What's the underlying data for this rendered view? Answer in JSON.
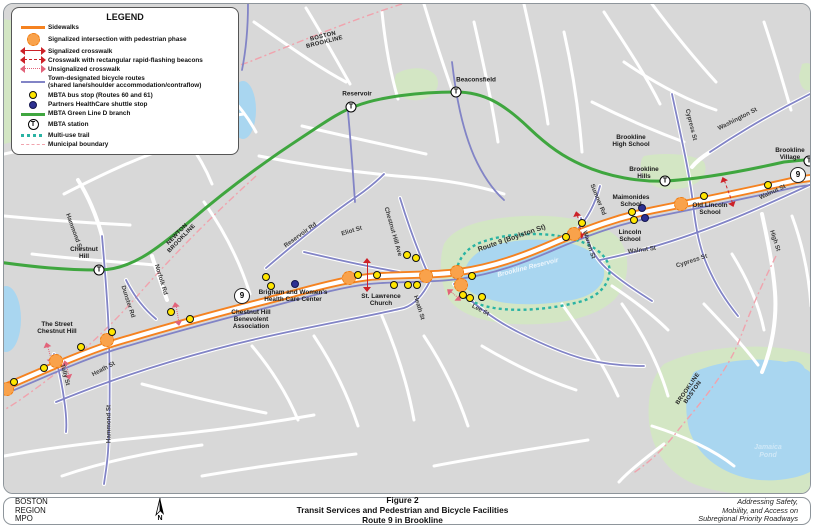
{
  "legend": {
    "title": "LEGEND",
    "items": [
      {
        "symbol": "sidewalk-line",
        "label": "Sidewalks"
      },
      {
        "symbol": "signalized-intersection",
        "label": "Signalized intersection with pedestrian phase"
      },
      {
        "symbol": "signalized-crosswalk",
        "label": "Signalized crosswalk"
      },
      {
        "symbol": "rrfb-crosswalk",
        "label": "Crosswalk with rectangular rapid-flashing beacons"
      },
      {
        "symbol": "unsignalized-crosswalk",
        "label": "Unsignalized crosswalk"
      },
      {
        "symbol": "bicycle-route",
        "label": "Town-designated bicycle routes\n(shared lane/shoulder accommodation/contraflow)"
      },
      {
        "symbol": "bus-stop",
        "label": "MBTA bus stop (Routes 60 and 61)"
      },
      {
        "symbol": "shuttle-stop",
        "label": "Partners HealthCare shuttle stop"
      },
      {
        "symbol": "green-line",
        "label": "MBTA Green Line D branch"
      },
      {
        "symbol": "mbta-station",
        "label": "MBTA station"
      },
      {
        "symbol": "multi-use-trail",
        "label": "Multi-use trail"
      },
      {
        "symbol": "municipal-boundary",
        "label": "Municipal boundary"
      }
    ]
  },
  "footer": {
    "agency_lines": [
      "BOSTON",
      "REGION",
      "MPO"
    ],
    "north_label": "N",
    "figure_label": "Figure 2",
    "title": "Transit Services and Pedestrian and Bicycle Facilities",
    "subtitle": "Route 9 in Brookline",
    "tagline": [
      "Addressing Safety,",
      "Mobility, and Access on",
      "Subregional Priority Roadways"
    ]
  },
  "map": {
    "station_glyph": "T",
    "colors": {
      "sidewalk": "#f58220",
      "crosswalk": "#cc2128",
      "unsignalized_crosswalk": "#e2637a",
      "bike_route": "#8284c6",
      "bus_stop": "#ffe600",
      "shuttle_stop": "#2e3192",
      "green_line": "#3fa63f",
      "multi_use_trail": "#2ab3a3",
      "municipal_boundary": "#f0a3ad",
      "water": "#a9d6f0",
      "park": "#d3e6c4",
      "background": "#d8d8d8"
    },
    "labels": [
      {
        "t": "BOSTON\nBROOKLINE",
        "x": 320,
        "y": 36,
        "r": -14,
        "c": "boundary"
      },
      {
        "t": "NEWTON\nBROOKLINE",
        "x": 176,
        "y": 233,
        "r": -46,
        "c": "boundary"
      },
      {
        "t": "BROOKLINE\nBOSTON",
        "x": 687,
        "y": 387,
        "r": -55,
        "c": "boundary"
      },
      {
        "t": "Reservoir",
        "x": 353,
        "y": 90,
        "r": 0,
        "c": "place"
      },
      {
        "t": "Beaconsfield",
        "x": 472,
        "y": 76,
        "r": 0,
        "c": "place"
      },
      {
        "t": "Chestnut\nHill",
        "x": 80,
        "y": 249,
        "r": 0,
        "c": "place"
      },
      {
        "t": "Brookline\nHigh School",
        "x": 627,
        "y": 137,
        "r": 0,
        "c": "place"
      },
      {
        "t": "Brookline\nHills",
        "x": 640,
        "y": 169,
        "r": 0,
        "c": "place"
      },
      {
        "t": "Brookline\nVillage",
        "x": 786,
        "y": 150,
        "r": 0,
        "c": "place"
      },
      {
        "t": "Maimonides\nSchool",
        "x": 627,
        "y": 197,
        "r": 0,
        "c": "place"
      },
      {
        "t": "Lincoln\nSchool",
        "x": 626,
        "y": 232,
        "r": 0,
        "c": "place"
      },
      {
        "t": "Old Lincoln\nSchool",
        "x": 706,
        "y": 205,
        "r": 0,
        "c": "place"
      },
      {
        "t": "The Street\nChestnut Hill",
        "x": 53,
        "y": 324,
        "r": 0,
        "c": "place"
      },
      {
        "t": "Chestnut Hill\nBenevolent\nAssociation",
        "x": 247,
        "y": 316,
        "r": 0,
        "c": "place"
      },
      {
        "t": "Brigham and Women's\nHealth Care Center",
        "x": 289,
        "y": 292,
        "r": 0,
        "c": "place"
      },
      {
        "t": "St. Lawrence\nChurch",
        "x": 377,
        "y": 296,
        "r": 0,
        "c": "place"
      },
      {
        "t": "Hammond St",
        "x": 69,
        "y": 228,
        "r": 70,
        "c": "street"
      },
      {
        "t": "Hammond St",
        "x": 106,
        "y": 420,
        "r": -90,
        "c": "street"
      },
      {
        "t": "Heath St",
        "x": 100,
        "y": 366,
        "r": -28,
        "c": "street"
      },
      {
        "t": "Heath St",
        "x": 414,
        "y": 304,
        "r": 73,
        "c": "street"
      },
      {
        "t": "Tully St",
        "x": 60,
        "y": 371,
        "r": 75,
        "c": "street"
      },
      {
        "t": "Dunster Rd",
        "x": 123,
        "y": 298,
        "r": 72,
        "c": "street"
      },
      {
        "t": "Norfolk Rd",
        "x": 156,
        "y": 276,
        "r": 73,
        "c": "street"
      },
      {
        "t": "Reservoir Rd",
        "x": 297,
        "y": 232,
        "r": -36,
        "c": "street"
      },
      {
        "t": "Eliot St",
        "x": 348,
        "y": 228,
        "r": -17,
        "c": "street"
      },
      {
        "t": "Chestnut Hill Ave",
        "x": 388,
        "y": 228,
        "r": 74,
        "c": "street"
      },
      {
        "t": "Route 9 (Boylston St)",
        "x": 508,
        "y": 235,
        "r": -19,
        "c": "street route9"
      },
      {
        "t": "Lee St",
        "x": 476,
        "y": 307,
        "r": 28,
        "c": "street"
      },
      {
        "t": "Warren St",
        "x": 584,
        "y": 241,
        "r": 72,
        "c": "street"
      },
      {
        "t": "Sumner Rd",
        "x": 593,
        "y": 196,
        "r": 68,
        "c": "street"
      },
      {
        "t": "Walnut St",
        "x": 638,
        "y": 247,
        "r": -7,
        "c": "street"
      },
      {
        "t": "Walnut St",
        "x": 769,
        "y": 189,
        "r": -25,
        "c": "street"
      },
      {
        "t": "Cypress St",
        "x": 686,
        "y": 121,
        "r": 76,
        "c": "street"
      },
      {
        "t": "Cypress St",
        "x": 688,
        "y": 258,
        "r": -18,
        "c": "street"
      },
      {
        "t": "Washington St",
        "x": 734,
        "y": 116,
        "r": -27,
        "c": "street"
      },
      {
        "t": "High St",
        "x": 770,
        "y": 237,
        "r": 72,
        "c": "street"
      },
      {
        "t": "Brookline Reservoir",
        "x": 524,
        "y": 264,
        "r": -14,
        "c": "water-label"
      },
      {
        "t": "Jamaica Pond",
        "x": 764,
        "y": 448,
        "r": 0,
        "c": "water-label jamaica"
      }
    ],
    "stations": [
      {
        "name": "Chestnut Hill",
        "x": 95,
        "y": 266
      },
      {
        "name": "Reservoir",
        "x": 347,
        "y": 103
      },
      {
        "name": "Beaconsfield",
        "x": 452,
        "y": 88
      },
      {
        "name": "Brookline Hills",
        "x": 661,
        "y": 177
      },
      {
        "name": "Brookline Village",
        "x": 805,
        "y": 157
      }
    ],
    "route_shields": [
      {
        "t": "9",
        "x": 238,
        "y": 292
      },
      {
        "t": "9",
        "x": 794,
        "y": 171
      }
    ],
    "bus_stops": [
      [
        10,
        378
      ],
      [
        40,
        364
      ],
      [
        77,
        343
      ],
      [
        108,
        328
      ],
      [
        167,
        308
      ],
      [
        186,
        315
      ],
      [
        262,
        273
      ],
      [
        267,
        282
      ],
      [
        354,
        271
      ],
      [
        373,
        271
      ],
      [
        390,
        281
      ],
      [
        403,
        251
      ],
      [
        412,
        254
      ],
      [
        404,
        281
      ],
      [
        413,
        281
      ],
      [
        459,
        291
      ],
      [
        466,
        294
      ],
      [
        478,
        293
      ],
      [
        468,
        272
      ],
      [
        562,
        233
      ],
      [
        578,
        219
      ],
      [
        628,
        208
      ],
      [
        630,
        216
      ],
      [
        700,
        192
      ],
      [
        764,
        181
      ]
    ],
    "shuttle_stops": [
      [
        291,
        280
      ],
      [
        638,
        204
      ],
      [
        641,
        214
      ]
    ],
    "signalized_intersections": [
      [
        3,
        385
      ],
      [
        52,
        357
      ],
      [
        103,
        336
      ],
      [
        345,
        274
      ],
      [
        422,
        272
      ],
      [
        453,
        268
      ],
      [
        457,
        281
      ],
      [
        570,
        230
      ],
      [
        677,
        200
      ]
    ],
    "crosswalks": [
      {
        "x": 363,
        "y": 271,
        "r": 90,
        "l": 34,
        "type": "solid"
      },
      {
        "x": 575,
        "y": 221,
        "r": 78,
        "l": 28,
        "type": "dashed"
      },
      {
        "x": 724,
        "y": 188,
        "r": 70,
        "l": 32,
        "type": "dashed"
      },
      {
        "x": 45,
        "y": 349,
        "r": 75,
        "l": 22,
        "type": "dotted"
      },
      {
        "x": 63,
        "y": 366,
        "r": 75,
        "l": 20,
        "type": "dotted"
      },
      {
        "x": 173,
        "y": 310,
        "r": 80,
        "l": 24,
        "type": "dotted"
      },
      {
        "x": 450,
        "y": 291,
        "r": 40,
        "l": 18,
        "type": "dotted"
      }
    ]
  }
}
